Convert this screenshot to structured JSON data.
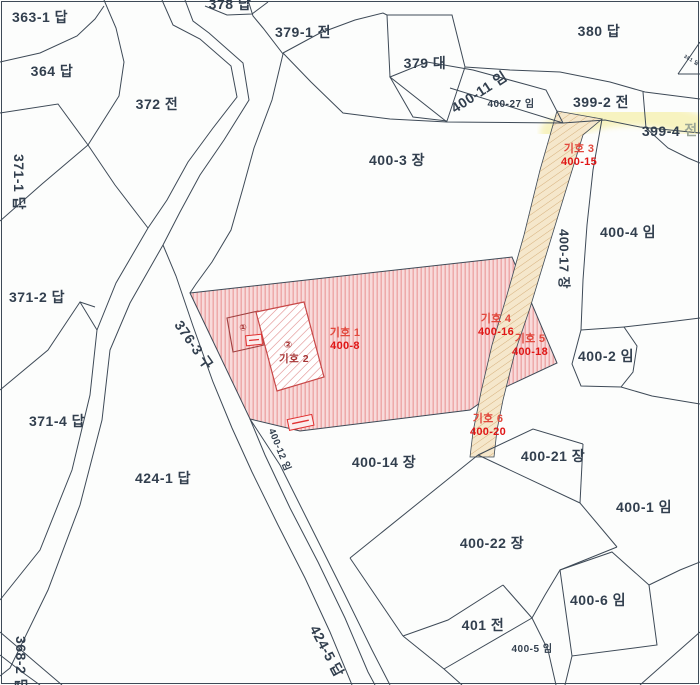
{
  "map": {
    "title": "cadastral-parcel-map",
    "colors": {
      "background": "#fcfdfc",
      "boundary_line": "#3e4a57",
      "text": "#323f4e",
      "text_faded": "#9aa595",
      "red_zone_fill": "#f8dada",
      "red_zone_stripe": "#eca2a2",
      "building_hatch": "#e08888",
      "building_border": "#c84848",
      "path_fill": "#f5e7cb",
      "path_stripe": "#d6b07c",
      "highlight": "#f7f2ba",
      "marker_name": "#e2483d",
      "marker_parcel": "#e01616",
      "dark_red_label": "#a63535",
      "tiny_box_border": "#e03030"
    },
    "parcel_labels": [
      {
        "text": "363-1 답",
        "x": 40,
        "y": 17
      },
      {
        "text": "364 답",
        "x": 52,
        "y": 71
      },
      {
        "text": "372 전",
        "x": 157,
        "y": 104
      },
      {
        "text": "371-1 답",
        "x": 19,
        "y": 182,
        "rot": 90
      },
      {
        "text": "371-2 답",
        "x": 37,
        "y": 297
      },
      {
        "text": "371-4 답",
        "x": 57,
        "y": 421
      },
      {
        "text": "424-1 답",
        "x": 163,
        "y": 478
      },
      {
        "text": "368-2 답",
        "x": 21,
        "y": 664,
        "rot": 90
      },
      {
        "text": "376-3 구",
        "x": 194,
        "y": 345,
        "rot": 55
      },
      {
        "text": "424-5 답",
        "x": 327,
        "y": 651,
        "rot": 62
      },
      {
        "text": "400-12 임",
        "x": 279,
        "y": 450,
        "rot": 68,
        "size": 9.5
      },
      {
        "text": "378 답",
        "x": 230,
        "y": 4
      },
      {
        "text": "379-1 전",
        "x": 303,
        "y": 32
      },
      {
        "text": "379 대",
        "x": 425,
        "y": 63
      },
      {
        "text": "400-11 임",
        "x": 479,
        "y": 92,
        "rot": -33
      },
      {
        "text": "400-27 임",
        "x": 511,
        "y": 105,
        "size": 10
      },
      {
        "text": "380 답",
        "x": 599,
        "y": 31
      },
      {
        "text": "381 답",
        "x": 691,
        "y": 61,
        "rot": 30,
        "size": 5
      },
      {
        "text": "399-2 전",
        "x": 601,
        "y": 102
      },
      {
        "text": "399-4",
        "x": 661,
        "y": 131
      },
      {
        "text": "전",
        "x": 691,
        "y": 130,
        "color": "#9aa595"
      },
      {
        "text": "400-3 장",
        "x": 397,
        "y": 160
      },
      {
        "text": "400-4 임",
        "x": 628,
        "y": 232
      },
      {
        "text": "400-17 장",
        "x": 564,
        "y": 259,
        "rot": 90,
        "size": 13
      },
      {
        "text": "400-2 임",
        "x": 606,
        "y": 356
      },
      {
        "text": "400-21 장",
        "x": 553,
        "y": 456
      },
      {
        "text": "400-1 임",
        "x": 644,
        "y": 507
      },
      {
        "text": "400-14 장",
        "x": 384,
        "y": 462
      },
      {
        "text": "400-22 장",
        "x": 492,
        "y": 543
      },
      {
        "text": "400-6 임",
        "x": 598,
        "y": 600
      },
      {
        "text": "401 전",
        "x": 483,
        "y": 625
      },
      {
        "text": "400-5 임",
        "x": 532,
        "y": 650,
        "size": 10
      },
      {
        "text": "기호 2",
        "x": 294,
        "y": 359,
        "size": 10.5,
        "color": "#a63535"
      }
    ],
    "markers": [
      {
        "name": "기호 1",
        "parcel": "400-8",
        "x": 345,
        "y": 340
      },
      {
        "name": "기호 3",
        "parcel": "400-15",
        "x": 579,
        "y": 156
      },
      {
        "name": "기호 4",
        "parcel": "400-16",
        "x": 496,
        "y": 326
      },
      {
        "name": "기호 5",
        "parcel": "400-18",
        "x": 530,
        "y": 346
      },
      {
        "name": "기호 6",
        "parcel": "400-20",
        "x": 488,
        "y": 426
      }
    ],
    "building_symbols": [
      {
        "text": "①",
        "x": 243,
        "y": 328,
        "size": 9
      },
      {
        "text": "②",
        "x": 288,
        "y": 346,
        "size": 10
      }
    ]
  }
}
